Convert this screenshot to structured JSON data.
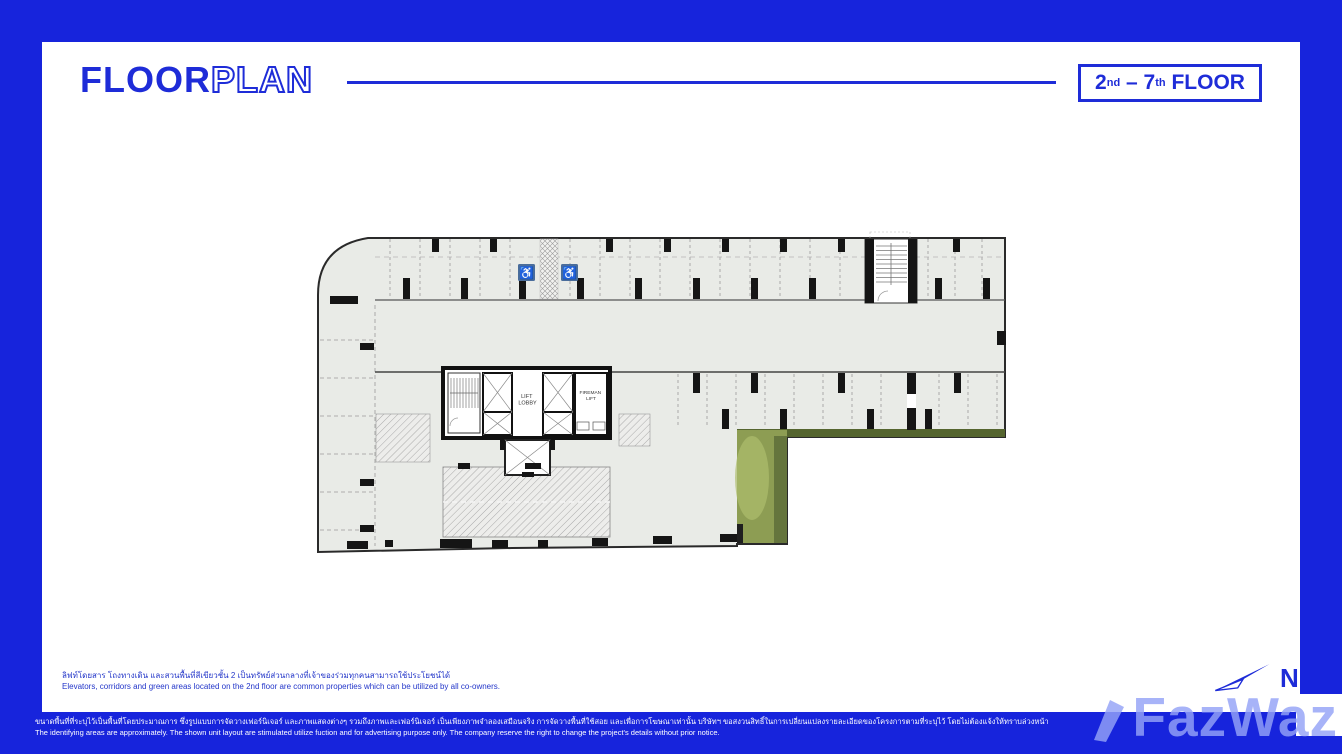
{
  "colors": {
    "frame_blue": "#1724DC",
    "brand_blue": "#1E2CD8",
    "plan_fill": "#E9EBE7",
    "plan_wall": "#1F1F1F",
    "green_main": "#8D9D53",
    "green_dark": "#55652F",
    "green_light": "#AEBE6D",
    "accessible_blue": "#4A6D9B",
    "watermark_blue": "#94A2F6"
  },
  "header": {
    "title_solid": "FLOOR",
    "title_outline": "PLAN",
    "badge": {
      "from": "2",
      "from_sup": "nd",
      "sep": " – ",
      "to": "7",
      "to_sup": "th",
      "suffix": " FLOOR"
    }
  },
  "plan": {
    "labels": {
      "lift_line1": "LIFT",
      "lift_line2": "LOBBY",
      "fireman_line1": "FIREMAN",
      "fireman_line2": "LIFT"
    },
    "icons": {
      "accessible_glyph": "♿"
    }
  },
  "notes": {
    "thai": "ลิฟท์โดยสาร โถงทางเดิน และสวนพื้นที่สีเขียวชั้น 2 เป็นทรัพย์ส่วนกลางที่เจ้าของร่วมทุกคนสามารถใช้ประโยชน์ได้",
    "english": "Elevators, corridors and green areas located on the 2nd floor are common properties which can be utilized by all co-owners."
  },
  "compass": {
    "label": "N"
  },
  "footer": {
    "thai": "ขนาดพื้นที่ที่ระบุไว้เป็นพื้นที่โดยประมาณการ ซึ่งรูปแบบการจัดวางเฟอร์นิเจอร์ และภาพแสดงต่างๆ รวมถึงภาพและเฟอร์นิเจอร์ เป็นเพียงภาพจำลองเสมือนจริง การจัดวางพื้นที่ใช้สอย และเพื่อการโฆษณาเท่านั้น บริษัทฯ ขอสงวนสิทธิ์ในการเปลี่ยนแปลงรายละเอียดของโครงการตามที่ระบุไว้ โดยไม่ต้องแจ้งให้ทราบล่วงหน้า",
    "english": "The identifying areas are approximately. The shown unit layout are stimulated utilize fuction and for advertising purpose only. The company reserve the right to change the project's details without prior notice."
  },
  "watermark": {
    "text": "FazWaz"
  }
}
